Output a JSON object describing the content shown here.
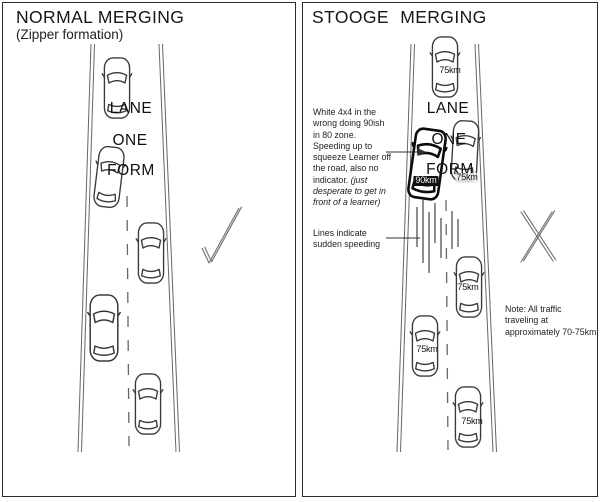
{
  "left_panel": {
    "title": "NORMAL MERGING",
    "subtitle": "(Zipper formation)",
    "road_words": [
      "LANE",
      "ONE",
      "FORM"
    ],
    "verdict": "approve"
  },
  "right_panel": {
    "title": "STOOGE MERGING",
    "road_words": [
      "LANE",
      "ONE",
      "FORM"
    ],
    "suv_annotation": {
      "text": "White 4x4 in the wrong doing 90ish in 80 zone. Speeding up to squeeze Learner off the road, also no indicator. ",
      "italic_text": "(just desperate to get in front of a learner)"
    },
    "speed_lines_label": "Lines indicate sudden speeding",
    "traffic_note": "Note: All traffic traveling at approximately 70-75km",
    "car_labels": {
      "top_car": "75km",
      "suv": "90km",
      "learner_car": "75km",
      "middle_car": "75km",
      "lower_left_car": "75km",
      "bottom_car": "75km"
    },
    "verdict": "reject"
  },
  "colors": {
    "road_line": "#666666",
    "car_outline": "#3a3a3a",
    "suv_outline": "#0d0d0d",
    "verdict_mark": "#6f6f6f",
    "text": "#1a1a1a"
  }
}
